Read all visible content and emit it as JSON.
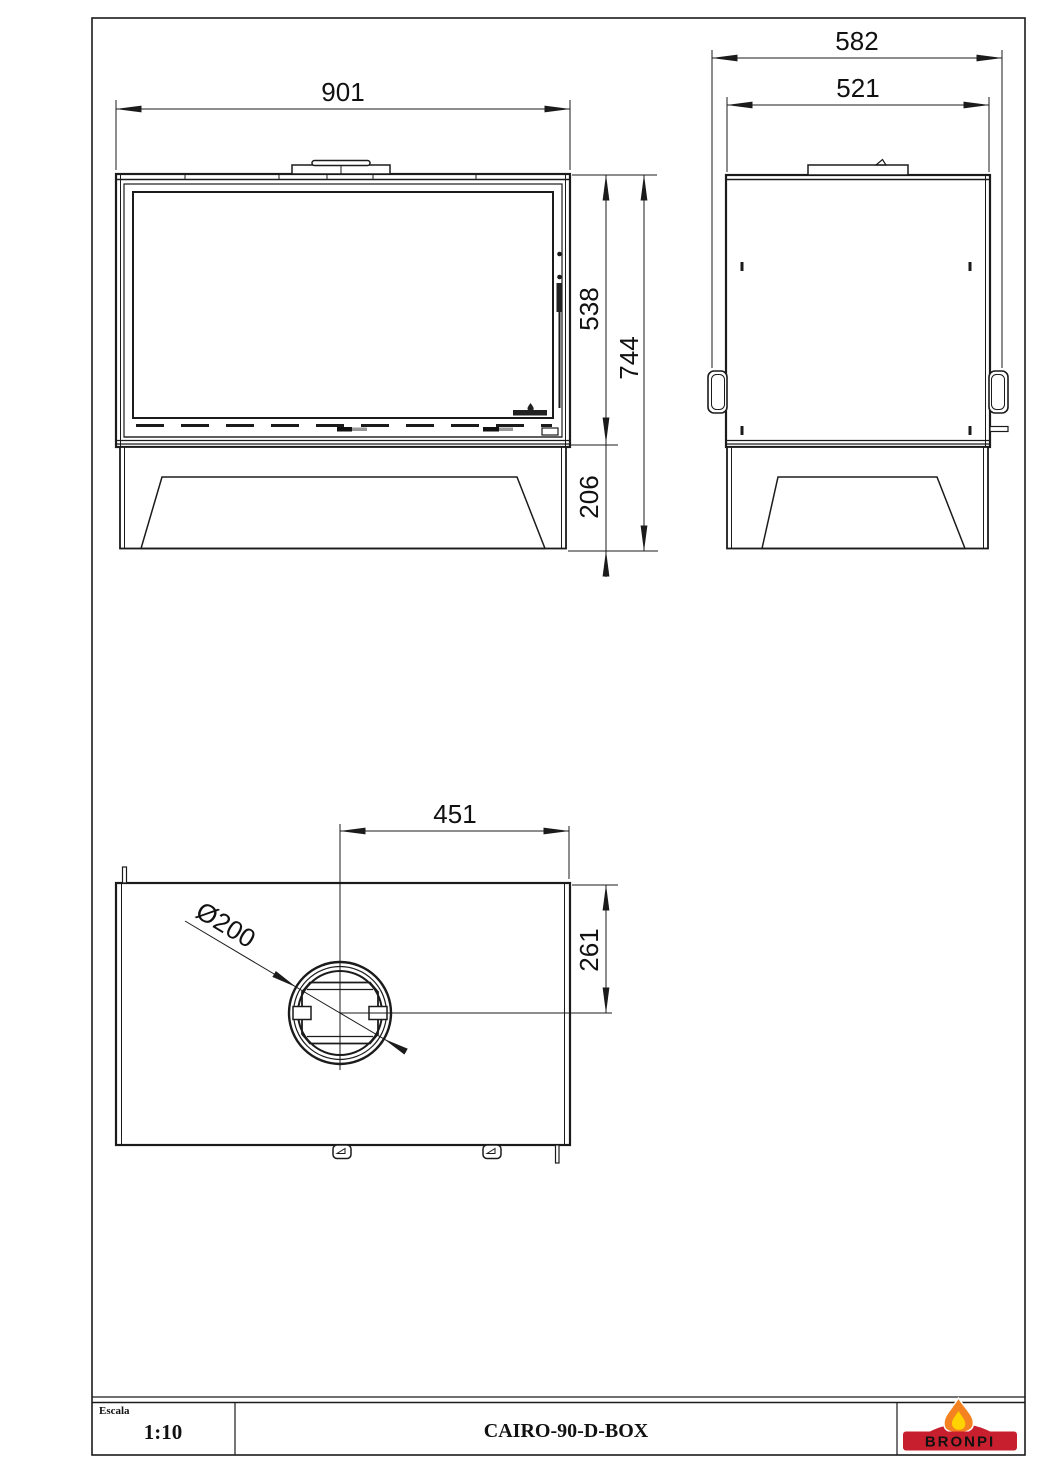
{
  "title_block": {
    "scale_label": "Escala",
    "scale_value": "1:10",
    "title": "CAIRO-90-D-BOX",
    "brand": "BRONPI",
    "logo_colors": {
      "red": "#c81f2e",
      "dark_red": "#8a1420",
      "orange": "#f58220",
      "yellow": "#ffd200"
    }
  },
  "front_view": {
    "name": "front elevation",
    "dims": {
      "width": "901",
      "body_height": "538",
      "overall_height": "744",
      "base_height": "206"
    }
  },
  "side_view": {
    "name": "side elevation",
    "dims": {
      "overall_depth": "582",
      "body_depth": "521"
    }
  },
  "top_view": {
    "name": "plan view",
    "dims": {
      "flue_center_to_right": "451",
      "flue_center_to_front": "261",
      "flue_diameter": "Ø200"
    }
  }
}
